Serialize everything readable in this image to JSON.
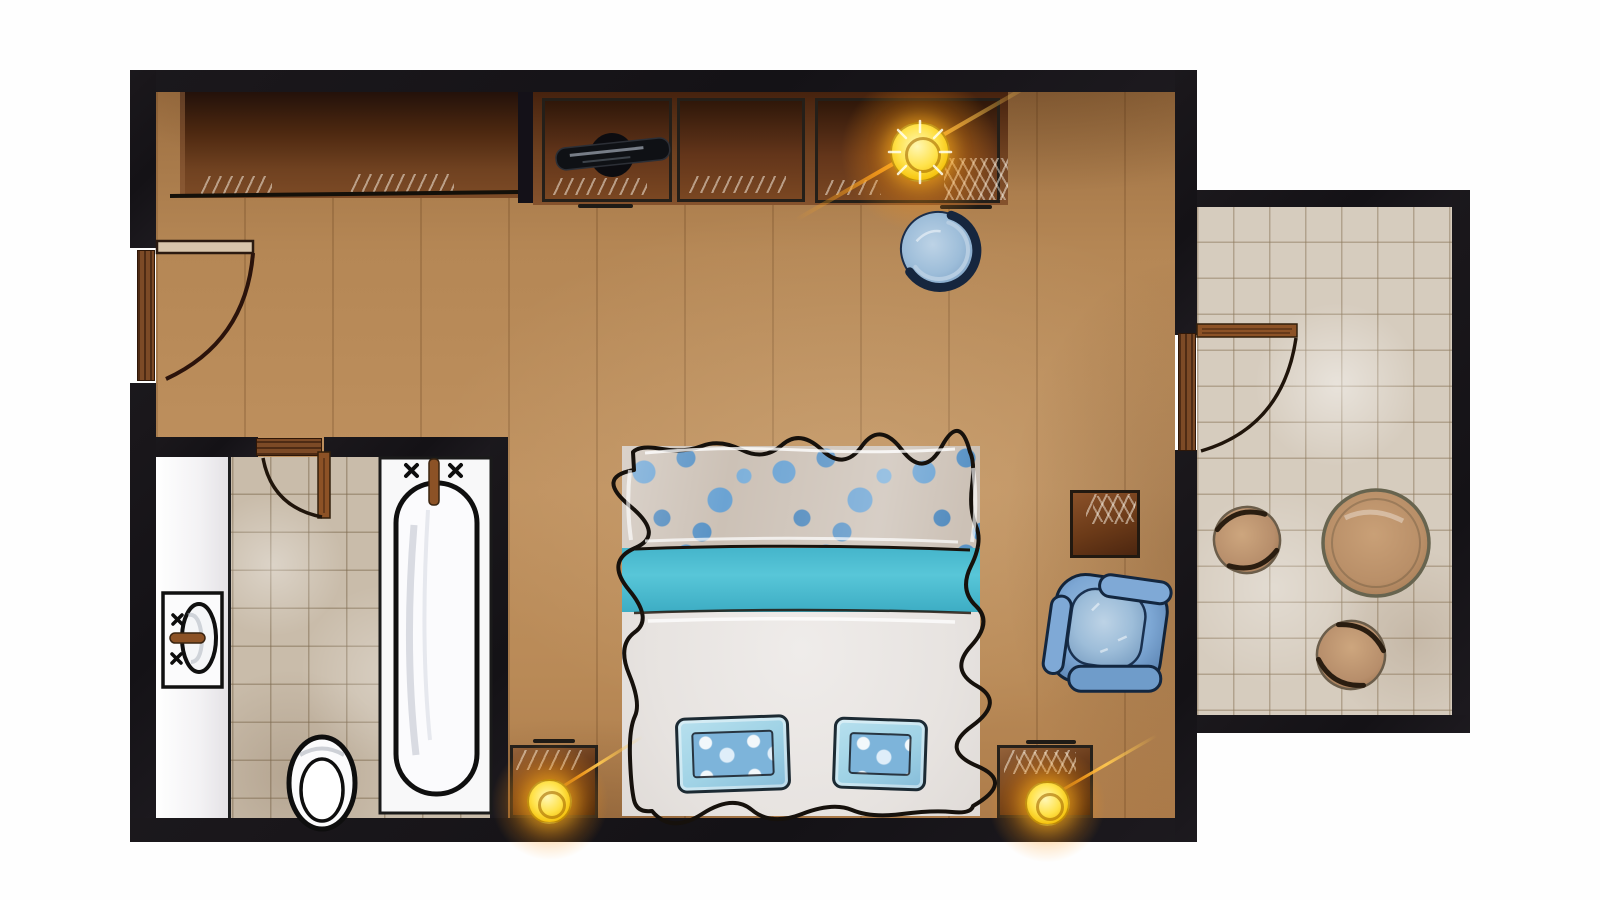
{
  "scene": {
    "kind": "floor-plan",
    "view": "top-down",
    "style": "hand-painted illustration",
    "text_visible": false
  },
  "rooms": [
    {
      "id": "bedroom",
      "floor": "wood-plank"
    },
    {
      "id": "bathroom",
      "floor": "ceramic-tile"
    },
    {
      "id": "balcony",
      "floor": "stone-tile"
    }
  ],
  "labels": {
    "bedroom": "Bedroom",
    "bathroom": "Bathroom",
    "balcony": "Balcony",
    "wardrobe": "Wardrobe / closet",
    "console": "Storage console with glass fronts",
    "tv": "TV",
    "console_lamp": "Lamp",
    "desk_chair": "Blue tub chair",
    "bed": "Double bed",
    "floral_spread": "Floral bedspread band",
    "teal_runner": "Teal runner",
    "duvet": "White duvet",
    "pillow_left": "Blue accent pillow",
    "pillow_right": "Blue accent pillow",
    "nightstand_left": "Nightstand",
    "nightstand_right": "Nightstand",
    "bedside_lamp_left": "Bedside lamp",
    "bedside_lamp_right": "Bedside lamp",
    "side_table": "Side table",
    "armchair": "Blue armchair",
    "vanity": "Vanity counter",
    "sink": "Washbasin",
    "toilet": "Toilet",
    "bathtub": "Bathtub",
    "entry_door": "Entry door",
    "bathroom_door": "Bathroom door",
    "balcony_door": "Balcony door",
    "balcony_table": "Round table",
    "stool_1": "Stool",
    "stool_2": "Stool"
  },
  "palette": {
    "wall": "#18151a",
    "wood_floor": "#b8895a",
    "bathroom_tile": "#c9bcaa",
    "balcony_tile": "#d6ccbe",
    "cabinet_brown": "#6e3d1d",
    "door_wood": "#8c5226",
    "bed_teal": "#4cbfd4",
    "bed_floral_blue": "#5f9bcc",
    "duvet_white": "#e9e5e2",
    "pillow_blue": "#a3d4e6",
    "chair_blue": "#7aa3d0",
    "chair_navy": "#16293f",
    "lamp_yellow": "#ffd21c",
    "lamp_glow": "#ff9d00",
    "fixture_white": "#f7f7f8",
    "sketch_ink": "#17120d",
    "tan_furniture": "#bb9069"
  }
}
